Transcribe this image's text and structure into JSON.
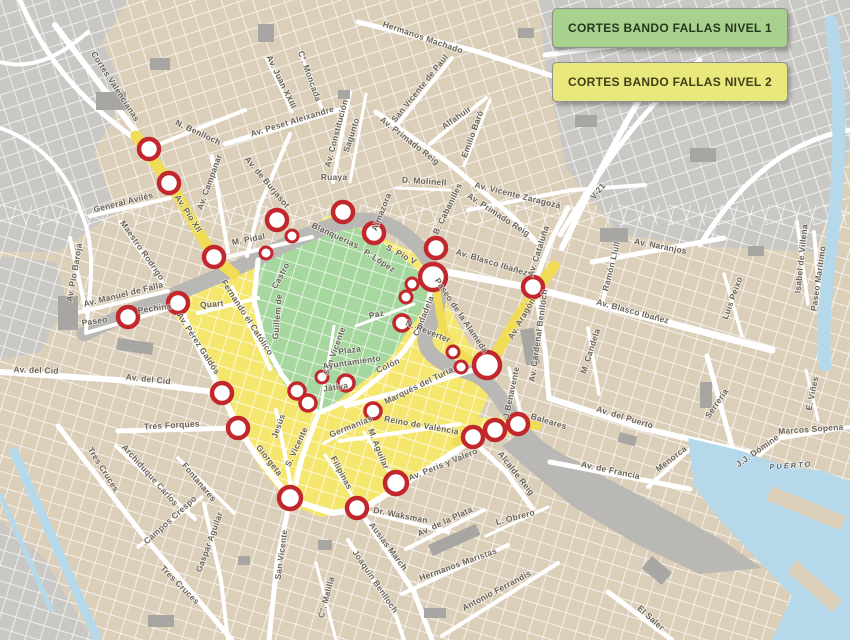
{
  "legend": {
    "items": [
      {
        "label": "CORTES BANDO FALLAS NIVEL 1",
        "fill": "#a9d18e",
        "text_color": "#24381c"
      },
      {
        "label": "CORTES BANDO FALLAS NIVEL 2",
        "fill": "#e9e87c",
        "text_color": "#3f3f18"
      }
    ],
    "border_color": "#8f8f8f"
  },
  "map": {
    "colors": {
      "base": "#dccfb9",
      "outskirt": "#c9c8c4",
      "riverbed": "#b9b8b4",
      "building": "#a7a6a2",
      "water": "#b5d9ea",
      "road": "#ffffff",
      "nivel1_zone": "#a6d79e",
      "nivel2_zone": "#f5e76e",
      "nivel2_strip": "#f0dd55",
      "marker_ring": "#c1272d",
      "marker_fill": "#ffffff",
      "label": "#6a6359",
      "water_label": "#5b6670"
    },
    "street_labels": [
      {
        "t": "Cortes Valencianas",
        "x": 113,
        "y": 88,
        "r": 57
      },
      {
        "t": "N. Benlloch",
        "x": 197,
        "y": 135,
        "r": 25
      },
      {
        "t": "General Avilés",
        "x": 124,
        "y": 205,
        "r": -14
      },
      {
        "t": "Av. Pío Baroja",
        "x": 77,
        "y": 273,
        "r": -80
      },
      {
        "t": "Maestro Rodrigo",
        "x": 140,
        "y": 252,
        "r": 55
      },
      {
        "t": "Av. Manuel de Falla",
        "x": 124,
        "y": 297,
        "r": -14
      },
      {
        "t": "Paseo",
        "x": 95,
        "y": 324,
        "r": -8
      },
      {
        "t": "Pechina",
        "x": 155,
        "y": 311,
        "r": -8
      },
      {
        "t": "Av. Pío XII",
        "x": 186,
        "y": 215,
        "r": 57
      },
      {
        "t": "Av. Campanar",
        "x": 212,
        "y": 183,
        "r": -70
      },
      {
        "t": "Av. de Burjasot",
        "x": 265,
        "y": 184,
        "r": 50
      },
      {
        "t": "M. Pidal",
        "x": 249,
        "y": 242,
        "r": -11
      },
      {
        "t": "Av. Peset Aleixandre",
        "x": 293,
        "y": 124,
        "r": -17
      },
      {
        "t": "Av. Juan XXIII",
        "x": 279,
        "y": 83,
        "r": 64
      },
      {
        "t": "C°. Moncada",
        "x": 307,
        "y": 77,
        "r": 70
      },
      {
        "t": "Hermanos Machado",
        "x": 422,
        "y": 40,
        "r": 19
      },
      {
        "t": "San Vicente de Paul",
        "x": 422,
        "y": 90,
        "r": -51
      },
      {
        "t": "Av. Constitución",
        "x": 339,
        "y": 134,
        "r": -75
      },
      {
        "t": "Sagunto",
        "x": 354,
        "y": 136,
        "r": -72
      },
      {
        "t": "Ruaya",
        "x": 334,
        "y": 180,
        "r": 0
      },
      {
        "t": "D. Molinell",
        "x": 424,
        "y": 184,
        "r": 4
      },
      {
        "t": "Almazora",
        "x": 384,
        "y": 213,
        "r": -68
      },
      {
        "t": "B. Cabanilles",
        "x": 450,
        "y": 210,
        "r": -64
      },
      {
        "t": "Av. Primado Reig",
        "x": 408,
        "y": 143,
        "r": 38
      },
      {
        "t": "Av. Primado Reig",
        "x": 497,
        "y": 217,
        "r": 33
      },
      {
        "t": "Alfahuir",
        "x": 458,
        "y": 120,
        "r": -35
      },
      {
        "t": "Emilio Baró",
        "x": 475,
        "y": 135,
        "r": -70
      },
      {
        "t": "Av. Vicente Zaragozá",
        "x": 517,
        "y": 198,
        "r": 14
      },
      {
        "t": "V-21",
        "x": 600,
        "y": 193,
        "r": -50
      },
      {
        "t": "Av. Cataluña",
        "x": 541,
        "y": 252,
        "r": -72
      },
      {
        "t": "Av. Naranjos",
        "x": 660,
        "y": 249,
        "r": 11
      },
      {
        "t": "Ramón Llull",
        "x": 614,
        "y": 267,
        "r": -76
      },
      {
        "t": "Isabel de Villena",
        "x": 804,
        "y": 259,
        "r": -84
      },
      {
        "t": "Paseo Marítimo",
        "x": 821,
        "y": 279,
        "r": -82
      },
      {
        "t": "Luis Peixo",
        "x": 735,
        "y": 299,
        "r": -70
      },
      {
        "t": "Av. Blasco Ibañez",
        "x": 491,
        "y": 265,
        "r": 17
      },
      {
        "t": "Av. Blasco Ibañez",
        "x": 632,
        "y": 314,
        "r": 15
      },
      {
        "t": "Av. Aragón",
        "x": 524,
        "y": 320,
        "r": -60
      },
      {
        "t": "Paseo de la Alameda",
        "x": 459,
        "y": 317,
        "r": 56
      },
      {
        "t": "Av. Cardenal Benlloch",
        "x": 541,
        "y": 336,
        "r": -82
      },
      {
        "t": "M. Candela",
        "x": 593,
        "y": 352,
        "r": -72
      },
      {
        "t": "Av. del Puerto",
        "x": 624,
        "y": 420,
        "r": 17
      },
      {
        "t": "Serrería",
        "x": 719,
        "y": 405,
        "r": -55
      },
      {
        "t": "Marcos Sopena",
        "x": 811,
        "y": 432,
        "r": -4
      },
      {
        "t": "J.J. Dómine",
        "x": 759,
        "y": 453,
        "r": -35
      },
      {
        "t": "E. Viñes",
        "x": 815,
        "y": 394,
        "r": -78
      },
      {
        "t": "Av. de Francia",
        "x": 610,
        "y": 473,
        "r": 12
      },
      {
        "t": "Menorca",
        "x": 673,
        "y": 461,
        "r": -38
      },
      {
        "t": "Baleares",
        "x": 548,
        "y": 424,
        "r": 17
      },
      {
        "t": "J.Benavente",
        "x": 514,
        "y": 393,
        "r": -78
      },
      {
        "t": "Alcalde Reig",
        "x": 514,
        "y": 475,
        "r": 52
      },
      {
        "t": "L. Obrero",
        "x": 516,
        "y": 520,
        "r": -15
      },
      {
        "t": "Hermanos Maristas",
        "x": 459,
        "y": 567,
        "r": -20
      },
      {
        "t": "Antonio Ferrandis",
        "x": 498,
        "y": 593,
        "r": -28
      },
      {
        "t": "El Saler",
        "x": 649,
        "y": 620,
        "r": 42
      },
      {
        "t": "Av. de la Plata",
        "x": 446,
        "y": 524,
        "r": -25
      },
      {
        "t": "Ausias March",
        "x": 386,
        "y": 548,
        "r": 53
      },
      {
        "t": "Joaquín Benlloch",
        "x": 373,
        "y": 583,
        "r": 56
      },
      {
        "t": "C°. Malilla",
        "x": 329,
        "y": 598,
        "r": -75
      },
      {
        "t": "San Vicente",
        "x": 284,
        "y": 555,
        "r": -82
      },
      {
        "t": "Gaspar Aguilar",
        "x": 212,
        "y": 543,
        "r": -70
      },
      {
        "t": "Tres Cruces",
        "x": 101,
        "y": 471,
        "r": 58
      },
      {
        "t": "Archiduque Carlos",
        "x": 148,
        "y": 477,
        "r": 48
      },
      {
        "t": "Fontanares",
        "x": 197,
        "y": 484,
        "r": 50
      },
      {
        "t": "Campos Crespo",
        "x": 172,
        "y": 522,
        "r": -42
      },
      {
        "t": "Tres Cruces",
        "x": 178,
        "y": 587,
        "r": 45
      },
      {
        "t": "Giorgeta",
        "x": 267,
        "y": 462,
        "r": 52
      },
      {
        "t": "Tres Forques",
        "x": 172,
        "y": 428,
        "r": -3
      },
      {
        "t": "Av. del Cid",
        "x": 36,
        "y": 373,
        "r": 2
      },
      {
        "t": "Av. del Cid",
        "x": 148,
        "y": 382,
        "r": 6
      },
      {
        "t": "Av. Pérez Galdós",
        "x": 196,
        "y": 345,
        "r": 57
      },
      {
        "t": "Fernando el Católico",
        "x": 245,
        "y": 319,
        "r": 57
      },
      {
        "t": "Quart",
        "x": 212,
        "y": 307,
        "r": -5
      },
      {
        "t": "Blanquerias",
        "x": 334,
        "y": 238,
        "r": 25
      },
      {
        "t": "P. López",
        "x": 378,
        "y": 263,
        "r": 33
      },
      {
        "t": "S. Pío V",
        "x": 400,
        "y": 257,
        "r": 28
      },
      {
        "t": "Castro",
        "x": 283,
        "y": 277,
        "r": -62
      },
      {
        "t": "Guillem de",
        "x": 280,
        "y": 317,
        "r": -85
      },
      {
        "t": "San Vicente",
        "x": 337,
        "y": 352,
        "r": -70
      },
      {
        "t": "Paz",
        "x": 377,
        "y": 317,
        "r": -12
      },
      {
        "t": "Plaza",
        "x": 350,
        "y": 353,
        "r": -8
      },
      {
        "t": "Ayuntamiento",
        "x": 352,
        "y": 365,
        "r": -8
      },
      {
        "t": "Colón",
        "x": 389,
        "y": 368,
        "r": -25
      },
      {
        "t": "Játiva",
        "x": 336,
        "y": 390,
        "r": -8
      },
      {
        "t": "Ciudadela",
        "x": 426,
        "y": 317,
        "r": -68
      },
      {
        "t": "N. Reverter",
        "x": 427,
        "y": 334,
        "r": 22
      },
      {
        "t": "Marqués del Turia",
        "x": 420,
        "y": 388,
        "r": -26
      },
      {
        "t": "Germanías",
        "x": 352,
        "y": 429,
        "r": -22
      },
      {
        "t": "Reino de València",
        "x": 421,
        "y": 428,
        "r": 10
      },
      {
        "t": "M. Aguilar",
        "x": 376,
        "y": 450,
        "r": 68
      },
      {
        "t": "Filipinas",
        "x": 339,
        "y": 474,
        "r": 62
      },
      {
        "t": "Jesús",
        "x": 281,
        "y": 427,
        "r": -70
      },
      {
        "t": "S. Vicente",
        "x": 299,
        "y": 448,
        "r": -65
      },
      {
        "t": "Av. Peris y Valero",
        "x": 444,
        "y": 467,
        "r": -22
      },
      {
        "t": "Dr. Waksman",
        "x": 400,
        "y": 518,
        "r": 11
      },
      {
        "t": "PUERTO",
        "x": 791,
        "y": 468,
        "r": -4,
        "style": "water"
      }
    ],
    "markers": [
      {
        "x": 149,
        "y": 149,
        "rad": 10
      },
      {
        "x": 169,
        "y": 183,
        "rad": 10
      },
      {
        "x": 214,
        "y": 257,
        "rad": 10
      },
      {
        "x": 266,
        "y": 253,
        "rad": 6
      },
      {
        "x": 292,
        "y": 236,
        "rad": 6
      },
      {
        "x": 277,
        "y": 220,
        "rad": 10
      },
      {
        "x": 343,
        "y": 212,
        "rad": 10
      },
      {
        "x": 374,
        "y": 233,
        "rad": 10
      },
      {
        "x": 436,
        "y": 248,
        "rad": 10
      },
      {
        "x": 433,
        "y": 277,
        "rad": 13
      },
      {
        "x": 412,
        "y": 284,
        "rad": 6
      },
      {
        "x": 406,
        "y": 297,
        "rad": 6
      },
      {
        "x": 533,
        "y": 287,
        "rad": 10
      },
      {
        "x": 402,
        "y": 323,
        "rad": 8
      },
      {
        "x": 453,
        "y": 352,
        "rad": 6
      },
      {
        "x": 461,
        "y": 367,
        "rad": 6
      },
      {
        "x": 487,
        "y": 365,
        "rad": 13
      },
      {
        "x": 178,
        "y": 303,
        "rad": 10
      },
      {
        "x": 128,
        "y": 317,
        "rad": 10
      },
      {
        "x": 222,
        "y": 393,
        "rad": 10
      },
      {
        "x": 238,
        "y": 428,
        "rad": 10
      },
      {
        "x": 290,
        "y": 498,
        "rad": 11
      },
      {
        "x": 322,
        "y": 377,
        "rad": 6
      },
      {
        "x": 346,
        "y": 383,
        "rad": 8
      },
      {
        "x": 297,
        "y": 391,
        "rad": 8
      },
      {
        "x": 308,
        "y": 403,
        "rad": 8
      },
      {
        "x": 373,
        "y": 411,
        "rad": 8
      },
      {
        "x": 396,
        "y": 483,
        "rad": 11
      },
      {
        "x": 357,
        "y": 508,
        "rad": 10
      },
      {
        "x": 473,
        "y": 437,
        "rad": 10
      },
      {
        "x": 495,
        "y": 430,
        "rad": 10
      },
      {
        "x": 518,
        "y": 424,
        "rad": 10
      }
    ]
  }
}
